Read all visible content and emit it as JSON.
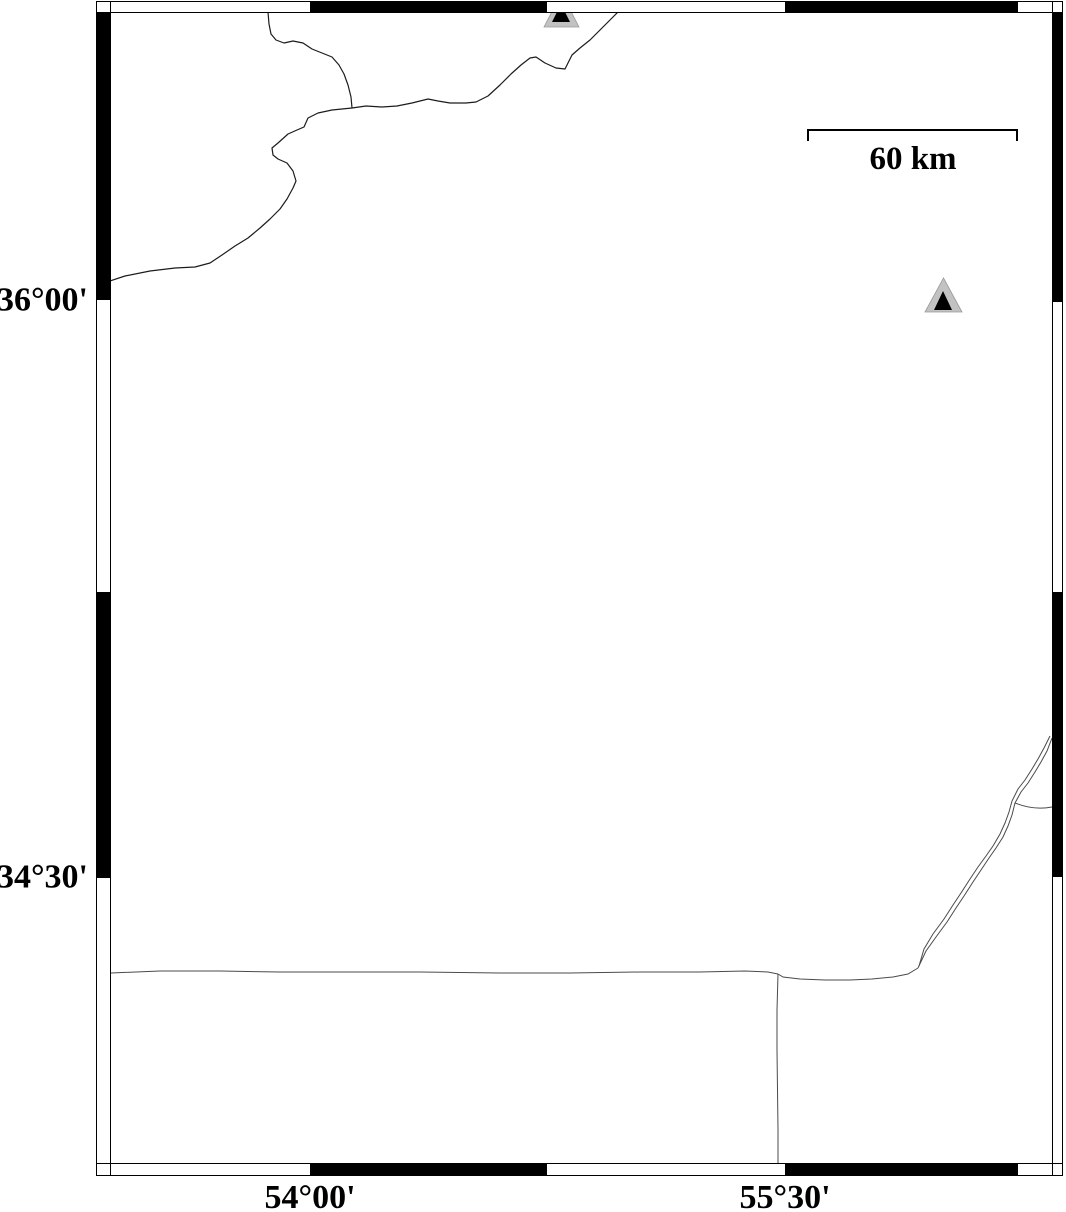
{
  "map": {
    "type": "geographic-map-figure",
    "labels": {
      "lat_top": "36°00'",
      "lat_bottom": "34°30'",
      "lon_left": "54°00'",
      "lon_right": "55°30'"
    },
    "scale_bar": {
      "label": "60 km"
    },
    "markers": {
      "symbol": "triangle",
      "count": 2,
      "fill_outer": "#c2c2c2",
      "fill_inner": "#000000"
    },
    "colors": {
      "frame": "#000000",
      "coastline": "#1c1c1c",
      "border_line": "#4a4a4a",
      "background": "#ffffff"
    }
  }
}
